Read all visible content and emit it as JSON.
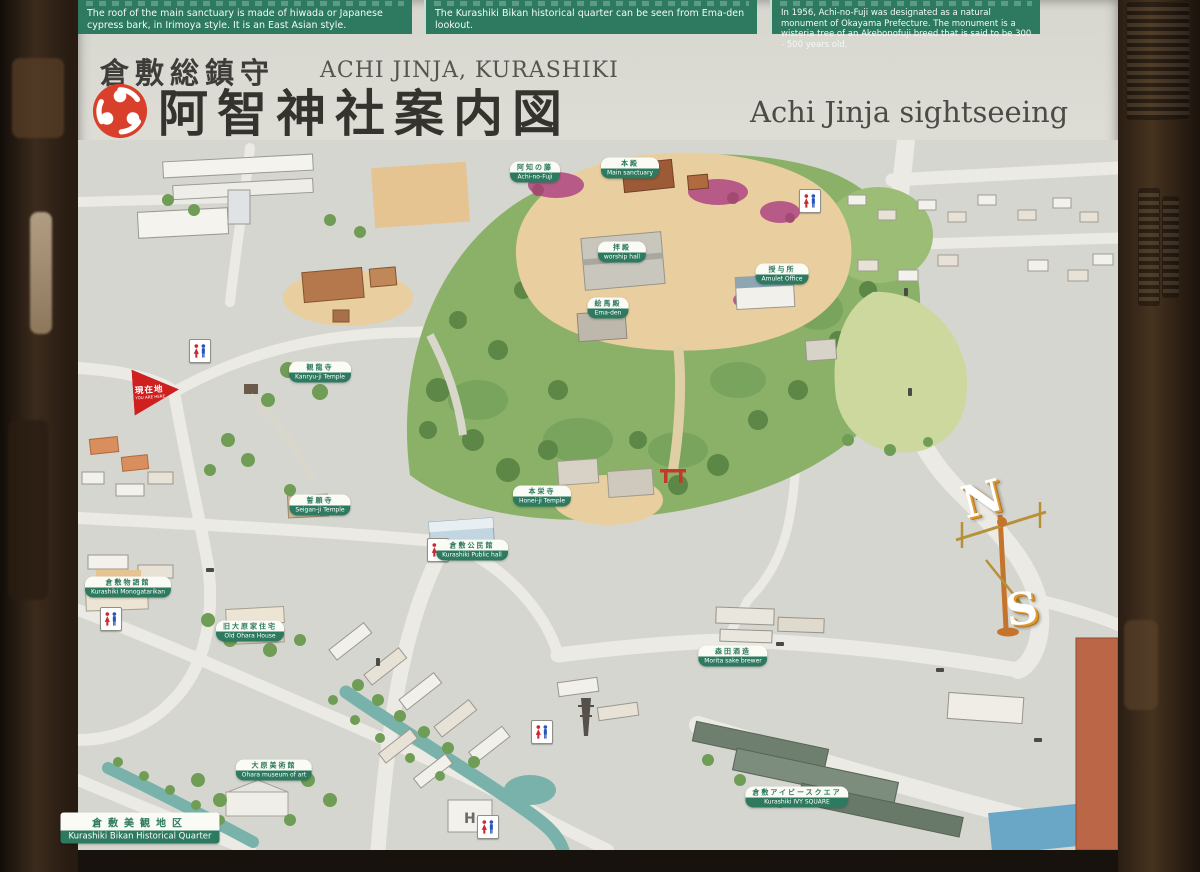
{
  "sign": {
    "header_notes": [
      {
        "en": "The roof of the main sanctuary is made of hiwada or Japanese cypress bark, in Irimoya style. It is an East Asian style."
      },
      {
        "en": "The Kurashiki Bikan historical quarter can be seen from Ema-den lookout."
      },
      {
        "en": "In 1956, Achi-no-Fuji was designated as a natural monument of Okayama Prefecture. The monument is a wisteria tree of an Akebonofuji breed that is said to be 300 - 500 years old."
      }
    ],
    "title": {
      "honorific_jp": "倉敷総鎮守",
      "shrine_romaji": "ACHI JINJA, KURASHIKI",
      "main_jp": "阿智神社案内図",
      "subtitle_en": "Achi Jinja sightseeing map"
    },
    "you_are_here": {
      "jp": "現在地",
      "en": "YOU ARE HERE"
    },
    "compass": {
      "north": "N",
      "south": "S"
    },
    "hotel_mark": "H",
    "labels": [
      {
        "id": "achi-no-fuji",
        "jp": "阿知の藤",
        "en": "Achi-no-Fuji"
      },
      {
        "id": "main-sanctuary",
        "jp": "本殿",
        "en": "Main sanctuary"
      },
      {
        "id": "worship-hall",
        "jp": "拝殿",
        "en": "worship hall"
      },
      {
        "id": "ema-den",
        "jp": "絵馬殿",
        "en": "Ema-den"
      },
      {
        "id": "amulet-office",
        "jp": "授与所",
        "en": "Amulet Office"
      },
      {
        "id": "kanryuji",
        "jp": "観龍寺",
        "en": "Kanryu-ji Temple"
      },
      {
        "id": "seiganji",
        "jp": "誓願寺",
        "en": "Seigan-ji Temple"
      },
      {
        "id": "public-hall",
        "jp": "倉敷公民館",
        "en": "Kurashiki Public hall"
      },
      {
        "id": "honeiji",
        "jp": "本栄寺",
        "en": "Honei-ji Temple"
      },
      {
        "id": "monogatarikan",
        "jp": "倉敷物語館",
        "en": "Kurashiki Monogatarikan"
      },
      {
        "id": "old-ohara-house",
        "jp": "旧大原家住宅",
        "en": "Old Ohara House"
      },
      {
        "id": "ohara-museum",
        "jp": "大原美術館",
        "en": "Ohara museum of art"
      },
      {
        "id": "morita-sake",
        "jp": "森田酒造",
        "en": "Morita sake brewer"
      },
      {
        "id": "ivy-square",
        "jp": "倉敷アイビースクエア",
        "en": "Kurashiki IVY SQUARE"
      },
      {
        "id": "bikan-quarter",
        "jp": "倉敷美観地区",
        "en": "Kurashiki Bikan Historical Quarter"
      }
    ],
    "colors": {
      "bar_green": "#2d7a60",
      "label_green": "#2d7a60",
      "crest_red": "#d8402c",
      "you_are_here_red": "#cf1f1f",
      "board_gray": "#d9d8d1",
      "frame_brown": "#3c2b1d"
    }
  }
}
